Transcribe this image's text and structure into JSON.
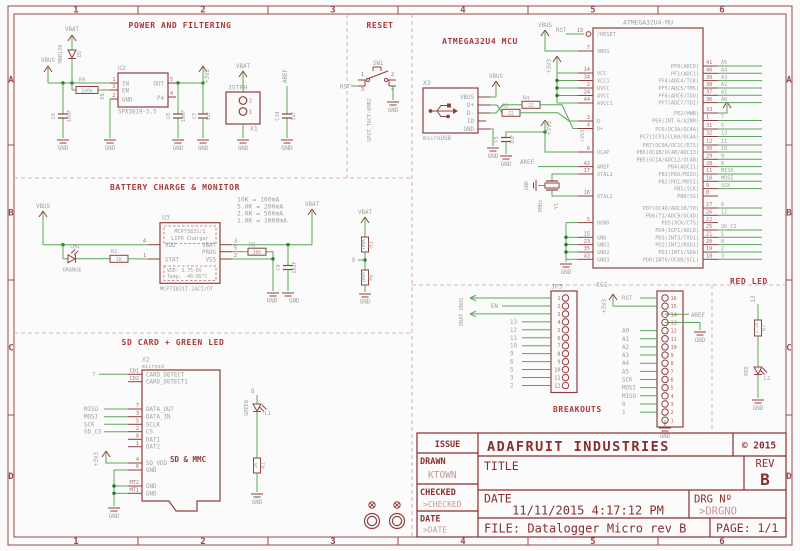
{
  "frame": {
    "columns": [
      "1",
      "2",
      "3",
      "4",
      "5",
      "6"
    ],
    "rows": [
      "A",
      "B",
      "C",
      "D"
    ]
  },
  "colors": {
    "symbol": "#8f3f3f",
    "wire": "#58a758",
    "junction": "#1f7a1f",
    "label_gray": "#9e9e9e",
    "pin_number": "#aa6b6b",
    "section_title": "#b03535",
    "dashed_border": "#dbadad",
    "titleblock": "#8a2e2e",
    "titleblock_light": "#cc9595",
    "background": "#fbfbfb"
  },
  "power": {
    "title": "POWER AND FILTERING",
    "d5": {
      "name": "D5",
      "value": "MBR120"
    },
    "u2": {
      "name": "U2",
      "value": "SPX3819-3.3",
      "pin_in": "IN",
      "pin_out": "OUT",
      "pin_en": "EN",
      "pin_gnd": "GND",
      "pin_p4": "P4",
      "num_in": "1",
      "num_en": "3",
      "num_gnd": "2",
      "num_out": "5",
      "num_p4": "4",
      "net_en": "EN"
    },
    "r9": {
      "name": "R9",
      "value": "100k"
    },
    "c6": {
      "name": "C6",
      "value": "10uF"
    },
    "c8": {
      "name": "C8",
      "value": "10uF"
    },
    "c7": {
      "name": "C7",
      "value": "1uF"
    },
    "x1": {
      "name": "X1",
      "value": "JSTPH",
      "num_top": "2",
      "num_bottom": "1"
    },
    "c14": {
      "name": "C14",
      "value": "1uF"
    },
    "net_vbat": "VBAT",
    "net_vbus": "VBUS",
    "net_3v3": "+3V3",
    "net_aref": "AREF",
    "gnd": "GND"
  },
  "reset": {
    "title": "RESET",
    "sw": {
      "name": "SW1",
      "value": "SPST_TACT-KMR2",
      "pins": [
        "1",
        "2",
        "3",
        "4"
      ]
    },
    "net_rst": "RST",
    "gnd": "GND"
  },
  "mcu": {
    "title": "ATMEGA32U4 MCU",
    "x3": {
      "name": "X3",
      "value": "microUSB",
      "pins": [
        "VBUS",
        "D+",
        "D-",
        "ID",
        "GND"
      ]
    },
    "r4": {
      "name": "R4",
      "value": "22"
    },
    "r5": {
      "name": "R5",
      "value": "22"
    },
    "c5": {
      "name": "C5",
      "value": "1uF"
    },
    "y1": {
      "name": "Y1",
      "value": "8MHz"
    },
    "net_vbus": "VBUS",
    "net_3v3": "+3V3",
    "net_rst": "RST",
    "net_aref": "AREF",
    "gnd": "GND",
    "ic": {
      "name": "ATMEGA32U4-MU",
      "left_pins": [
        {
          "num": "13",
          "name": "/RESET"
        },
        {
          "num": "7",
          "name": "VBUS"
        },
        {
          "num": "14",
          "name": "VCC"
        },
        {
          "num": "34",
          "name": "VCC1"
        },
        {
          "num": "2",
          "name": "UVCC"
        },
        {
          "num": "24",
          "name": "AVCC"
        },
        {
          "num": "44",
          "name": "AVCC1"
        },
        {
          "num": "3",
          "name": "D-"
        },
        {
          "num": "4",
          "name": "D+"
        },
        {
          "num": "6",
          "name": "UCAP"
        },
        {
          "num": "42",
          "name": "AREF"
        },
        {
          "num": "17",
          "name": "XTAL1"
        },
        {
          "num": "16",
          "name": "XTAL2"
        },
        {
          "num": "5",
          "name": "UGND"
        },
        {
          "num": "15",
          "name": "GND"
        },
        {
          "num": "23",
          "name": "GND1"
        },
        {
          "num": "35",
          "name": "GND2"
        },
        {
          "num": "43",
          "name": "GND3"
        }
      ],
      "right_pins": [
        {
          "name": "PF0(ADC0)",
          "num": "41",
          "net": "A5"
        },
        {
          "name": "PF1(ADC1)",
          "num": "40",
          "net": "A4"
        },
        {
          "name": "PF4(ADC4/TCK)",
          "num": "39",
          "net": "A3"
        },
        {
          "name": "PF5(ADC5/TMS)",
          "num": "38",
          "net": "A2"
        },
        {
          "name": "PF6(ADC6/TDO)",
          "num": "37",
          "net": "A1"
        },
        {
          "name": "PF7(ADC7/TDI)",
          "num": "36",
          "net": "A0"
        },
        {
          "name": "PE2(HWB)",
          "num": "33",
          "net": ""
        },
        {
          "name": "PE6(INT.6/AIN0)",
          "num": "1",
          "net": "7"
        },
        {
          "name": "PC6(OC3A/OC4A)",
          "num": "31",
          "net": "5"
        },
        {
          "name": "PC7(ICP3/CLK0/OC4A)",
          "num": "32",
          "net": "13"
        },
        {
          "name": "PB7(OC0A/OC1C/RTS)",
          "num": "12",
          "net": "11"
        },
        {
          "name": "PB6(OC1B/OC4B/ADC13)",
          "num": "30",
          "net": "10"
        },
        {
          "name": "PB5(OC1A/ADC12/OC4B)",
          "num": "29",
          "net": "9"
        },
        {
          "name": "PB4(ADC11)",
          "num": "28",
          "net": "8"
        },
        {
          "name": "PB3(PDO/MISO)",
          "num": "11",
          "net": "MISO"
        },
        {
          "name": "PB2(PDI/MOSI)",
          "num": "10",
          "net": "MOSI"
        },
        {
          "name": "PB1(SCK)",
          "num": "9",
          "net": "SCK"
        },
        {
          "name": "PB0(SS)",
          "num": "8",
          "net": ""
        },
        {
          "name": "PD7(OC4D/ADC10/T0)",
          "num": "27",
          "net": "6"
        },
        {
          "name": "PD6(T1/ADC9/OC4D)",
          "num": "26",
          "net": "12"
        },
        {
          "name": "PD5(XCK/CTS)",
          "num": "22",
          "net": ""
        },
        {
          "name": "PD4(ICP1/ADC8)",
          "num": "25",
          "net": "SD_CS"
        },
        {
          "name": "PD3(INT3/TXD1)",
          "num": "21",
          "net": "1"
        },
        {
          "name": "PD2(INT2/RXD1)",
          "num": "20",
          "net": "0"
        },
        {
          "name": "PD1(INT1/SDA)",
          "num": "19",
          "net": "2"
        },
        {
          "name": "PD0(INT0/OC0B/SCL)",
          "num": "18",
          "net": "3"
        }
      ]
    }
  },
  "battery": {
    "title": "BATTERY CHARGE & MONITOR",
    "u3": {
      "name": "U3",
      "value": "MCP73831T-2ACI/OT",
      "line1": "MCP73831/2",
      "line2": "LIPO Charger",
      "spec1": "VDD:  3.75-6V",
      "spec2": "Temp: -40-85°C",
      "pin_vdd": "VDD",
      "pin_stat": "STAT",
      "pin_vbat": "VBAT",
      "pin_prog": "PROG",
      "pin_vss": "VSS",
      "num_vdd": "4",
      "num_stat": "1",
      "num_vbat": "3",
      "num_prog": "5",
      "num_vss": "2"
    },
    "notes": [
      "10K  = 100mA",
      "5.0K = 200mA",
      "2.0K = 500mA",
      "1.0K = 1000mA"
    ],
    "led": {
      "name": "CHG",
      "color_label": "ORANGE"
    },
    "r2": {
      "name": "R2",
      "value": "1K"
    },
    "r8": {
      "name": "R8",
      "value": "10K"
    },
    "c9": {
      "name": "C9",
      "value": "10uF"
    },
    "r3": {
      "name": "R3",
      "value": "100K"
    },
    "r6": {
      "name": "R6",
      "value": "100K"
    },
    "net_vbus": "VBUS",
    "net_vbat": "VBAT",
    "net_9": "9",
    "gnd": "GND"
  },
  "sdcard": {
    "title": "SD CARD + GREEN LED",
    "x2": {
      "name": "X2",
      "value": "microsd",
      "label": "SD & MMC",
      "pins": [
        {
          "des": "CD1",
          "name": "CARD_DETECT",
          "net": "7"
        },
        {
          "des": "CD2",
          "name": "CARD_DETECT1",
          "net": ""
        },
        {
          "des": "7",
          "name": "DATA_OUT",
          "net": "MISO"
        },
        {
          "des": "3",
          "name": "DATA_IN",
          "net": "MOSI"
        },
        {
          "des": "5",
          "name": "SCLK",
          "net": "SCK"
        },
        {
          "des": "2",
          "name": "CS",
          "net": "SD_CS"
        },
        {
          "des": "8",
          "name": "DAT1",
          "net": ""
        },
        {
          "des": "1",
          "name": "DAT2",
          "net": ""
        },
        {
          "des": "4",
          "name": "SD_VDD",
          "net": "+3V3"
        },
        {
          "des": "6",
          "name": "GND",
          "net": ""
        },
        {
          "des": "MT2",
          "name": "GND",
          "net": ""
        },
        {
          "des": "MT1",
          "name": "GND",
          "net": ""
        }
      ]
    },
    "led": {
      "name": "L1",
      "color_label": "GREEN",
      "net": "8"
    },
    "r1": {
      "name": "R1",
      "value": "1K"
    },
    "gnd": "GND"
  },
  "breakouts": {
    "title": "BREAKOUTS",
    "jp3": {
      "name": "JP3",
      "pins": [
        {
          "num": "1",
          "arrow": "VBUS"
        },
        {
          "num": "2",
          "net": "EN"
        },
        {
          "num": "3",
          "arrow": "VBAT"
        },
        {
          "num": "4",
          "net": "13"
        },
        {
          "num": "5",
          "net": "12"
        },
        {
          "num": "6",
          "net": "11"
        },
        {
          "num": "7",
          "net": "10"
        },
        {
          "num": "8",
          "net": "9"
        },
        {
          "num": "9",
          "net": "6"
        },
        {
          "num": "10",
          "net": "5"
        },
        {
          "num": "11",
          "net": "3"
        },
        {
          "num": "12",
          "net": "2"
        }
      ]
    },
    "ic1": {
      "name": "IC1",
      "pins": [
        {
          "num": "16",
          "net": "RST"
        },
        {
          "num": "15",
          "net": "+3V3",
          "special": "power"
        },
        {
          "num": "14",
          "net": "AREF",
          "special": "right"
        },
        {
          "num": "13",
          "net": "GND",
          "special": "right_gnd"
        },
        {
          "num": "12",
          "net": "A0"
        },
        {
          "num": "11",
          "net": "A1"
        },
        {
          "num": "10",
          "net": "A2"
        },
        {
          "num": "9",
          "net": "A3"
        },
        {
          "num": "8",
          "net": "A4"
        },
        {
          "num": "7",
          "net": "A5"
        },
        {
          "num": "6",
          "net": "SCK"
        },
        {
          "num": "5",
          "net": "MOSI"
        },
        {
          "num": "4",
          "net": "MISO"
        },
        {
          "num": "3",
          "net": "0"
        },
        {
          "num": "2",
          "net": "1"
        },
        {
          "num": "1",
          "net": "GND",
          "special": "below_gnd"
        }
      ]
    },
    "gnd": "GND"
  },
  "redled": {
    "title": "RED LED",
    "net": "13",
    "r7": {
      "name": "R7",
      "value": "2.2K"
    },
    "led": {
      "name": "L2",
      "color_label": "RED"
    },
    "gnd": "GND"
  },
  "titleblock": {
    "company": "ADAFRUIT INDUSTRIES",
    "copyright": "© 2015",
    "issue_label": "ISSUE",
    "drawn_label": "DRAWN",
    "drawn_value": "KTOWN",
    "checked_label": "CHECKED",
    "checked_value": ">CHECKED",
    "date_label": "DATE",
    "date_value": ">DATE",
    "title_label": "TITLE",
    "rev_label": "REV",
    "rev_value": "B",
    "date2_label": "DATE",
    "date2_value": "11/11/2015 4:17:12 PM",
    "drg_label": "DRG Nº",
    "drg_value": ">DRGNO",
    "file": "FILE: Datalogger Micro rev B",
    "page": "PAGE: 1/1"
  }
}
